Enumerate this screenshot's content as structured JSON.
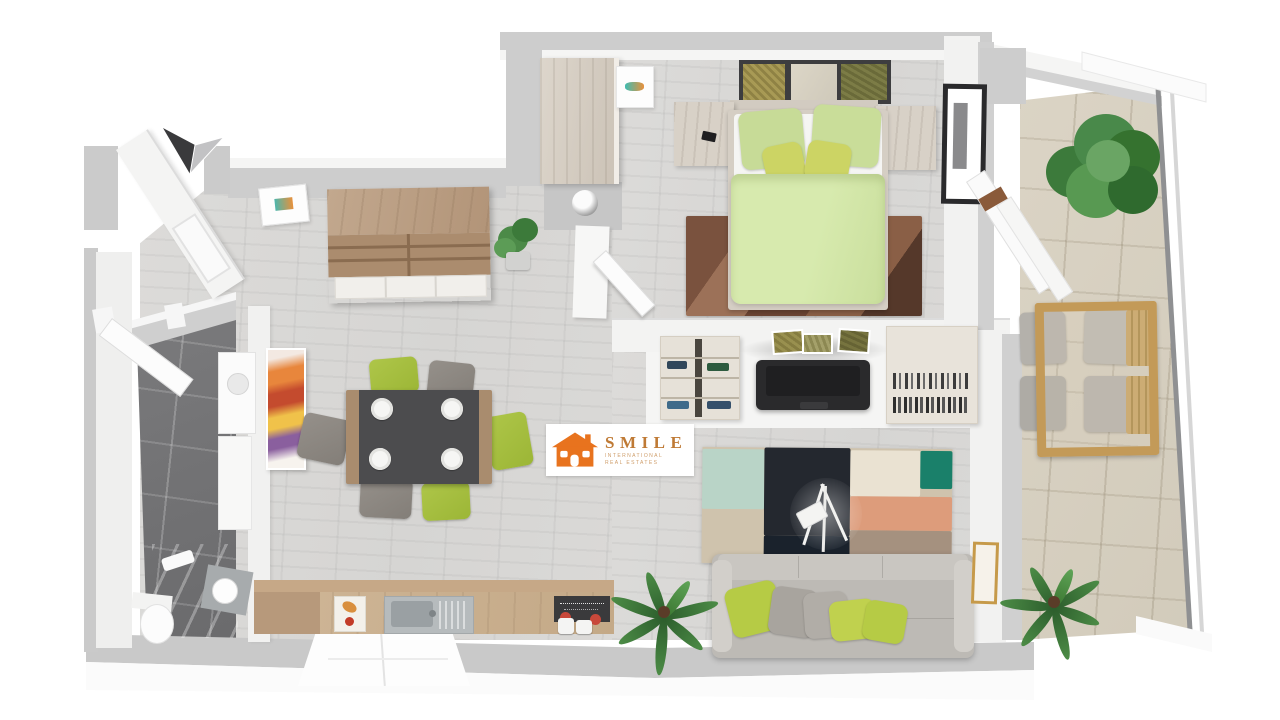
{
  "scene": {
    "kind": "3d-apartment-floor-plan-render",
    "view": "top-down dollhouse"
  },
  "logo": {
    "brand": "SMILE",
    "subtitle_line1": "INTERNATIONAL",
    "subtitle_line2": "REAL ESTATES",
    "brand_color": "#bf7a35",
    "icon_color": "#e8731e",
    "icon": "house-icon"
  },
  "compass": {
    "icon": "north-arrow-icon",
    "left_wing_color": "#3a3a3c",
    "right_wing_color": "#c2c2c4"
  },
  "palette": {
    "wall": "#cdcdcd",
    "wall_top": "#f5f5f4",
    "wood_floor": "#d8d7d5",
    "bathroom_tile": "#707072",
    "balcony_tile": "#d6cfc0",
    "accent_green": "#a6c13d",
    "bed_green": "#d3e6a6",
    "wood_furniture": "#b49a7f",
    "sofa_gray": "#bdbab5",
    "tv_black": "#2a2a2c",
    "rug_colors": [
      "#b9d4c7",
      "#24282f",
      "#eae2d2",
      "#1a806a",
      "#dd9c7b",
      "#a5917f",
      "#cfc3ad"
    ]
  },
  "rooms": {
    "entry": {
      "objects": [
        "diagonal-wall",
        "entry-door"
      ]
    },
    "living_dining": {
      "objects": [
        "sideboard",
        "potted-plant",
        "small-wall-frame",
        "porthole-wall",
        "dining-table",
        "plates",
        "chairs-green-gray",
        "abstract-painting",
        "kitchen-counter",
        "cutting-board",
        "sink",
        "dark-panel-with-canisters",
        "palm-plant"
      ]
    },
    "bathroom": {
      "objects": [
        "door",
        "washing-machine",
        "cabinet",
        "shower",
        "washbasin",
        "toilet"
      ]
    },
    "bedroom": {
      "objects": [
        "wardrobe",
        "bird-picture",
        "three-wall-pictures",
        "double-bed",
        "green-duvet",
        "pillows",
        "nightstands",
        "phone",
        "brown-rug",
        "black-framed-picture",
        "balcony-door"
      ]
    },
    "living_room": {
      "objects": [
        "media-shelf",
        "tv",
        "three-small-pictures",
        "book-shelf",
        "patchwork-rug",
        "tripod-floor-lamp",
        "sofa",
        "sofa-pillows",
        "palm-plant",
        "gold-frame"
      ]
    },
    "balcony": {
      "objects": [
        "leafy-potted-plant",
        "wooden-table",
        "four-chairs",
        "palm-plant",
        "glass-railing"
      ]
    }
  }
}
